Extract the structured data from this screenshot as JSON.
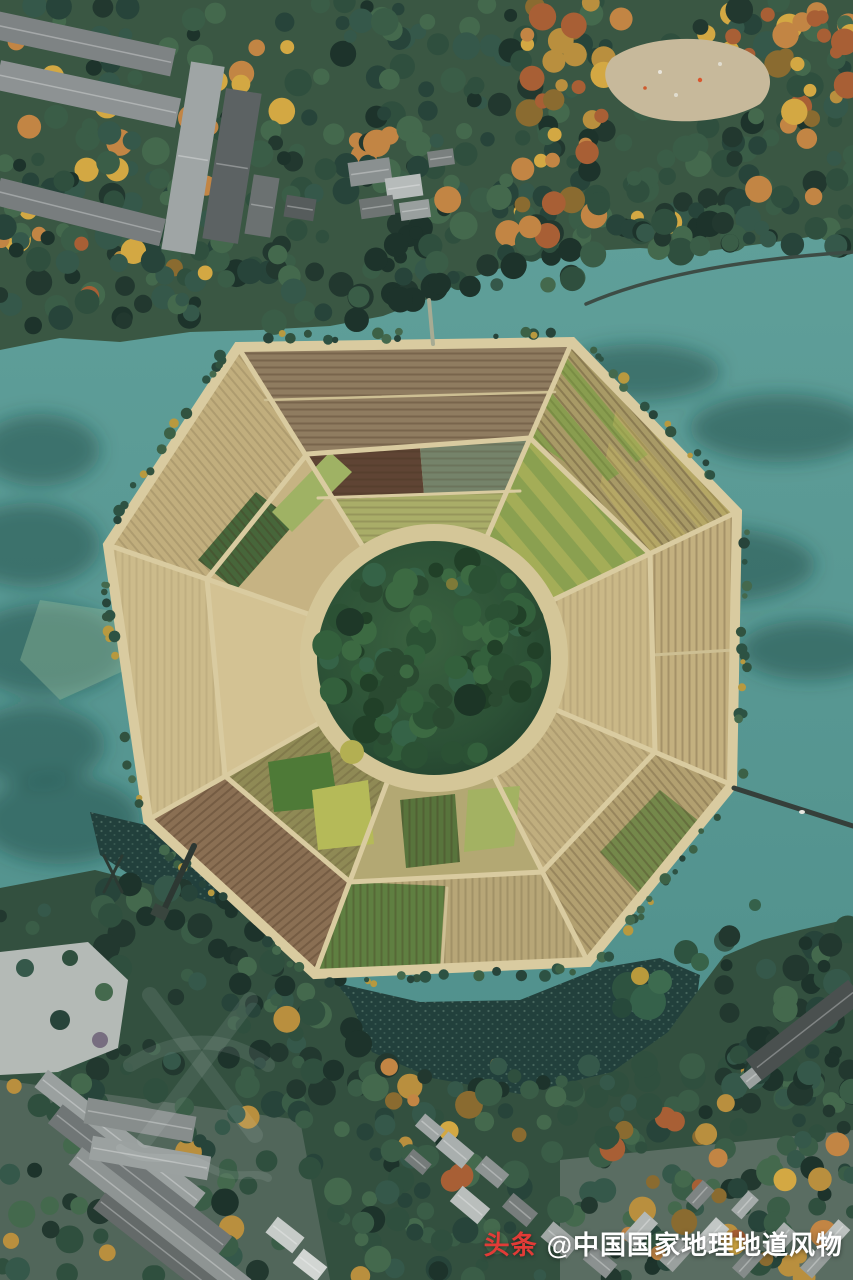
{
  "watermark": {
    "brand": "头条",
    "handle": "@中国国家地理地道风物"
  },
  "colors": {
    "water": "#579792",
    "water_shadow": "#1e4642",
    "pond": "#22403c",
    "forest_top": "#3a5743",
    "forest_bottom": "#33503f",
    "field_tan": "#c8b88c",
    "field_path": "#d9cba0",
    "inner_ring": "#d4c698",
    "plow_brown": "#8f7c60",
    "crop_green": "#4e7a37",
    "crop_chartreuse": "#aab06a",
    "crop_maroon": "#5f4434",
    "center_forest": "#2c5136",
    "clearing": "#c7b99b",
    "roof_gray": "#8d9293",
    "roof_light": "#b6bbba",
    "plaza": "#b4bab6",
    "autumn_orange": "#c28544",
    "autumn_yellow": "#d3a843",
    "watermark_red": "#e23b37",
    "watermark_white": "#ffffff"
  }
}
